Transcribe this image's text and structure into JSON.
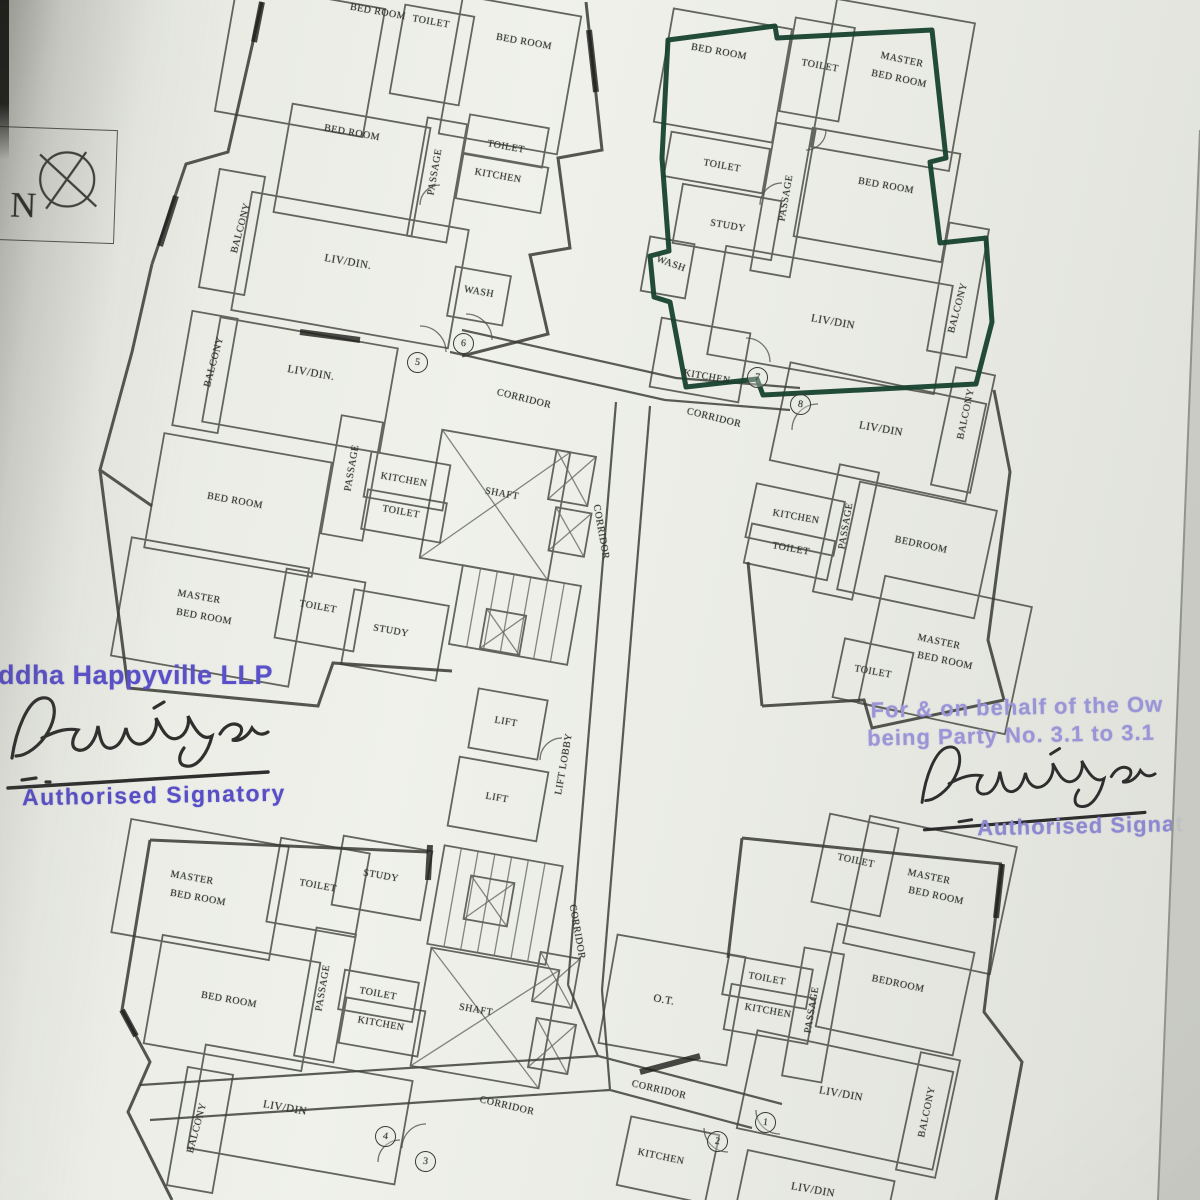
{
  "compass": {
    "label": "N"
  },
  "stamps": {
    "left": {
      "company": "ddha Happyville LLP",
      "signatory_title": "Authorised Signatory"
    },
    "right": {
      "line1": "For & on behalf of the Ow",
      "line2": "being Party No. 3.1 to 3.1",
      "signatory_title": "Authorised Signat"
    }
  },
  "colors": {
    "highlight_green": "#17412e",
    "stamp_purple": "#5a50c8",
    "stamp_lilac": "#9b95d8",
    "ink": "#1f1f1f",
    "wall": "#45473f",
    "paper": "#e8eae3"
  },
  "plan": {
    "labels": [
      {
        "t": "BED ROOM",
        "x": 378,
        "y": 12,
        "r": 10
      },
      {
        "t": "TOILET",
        "x": 431,
        "y": 22,
        "r": 10
      },
      {
        "t": "BED ROOM",
        "x": 524,
        "y": 42,
        "r": 10
      },
      {
        "t": "BED ROOM",
        "x": 352,
        "y": 133,
        "r": 10
      },
      {
        "t": "PASSAGE",
        "x": 435,
        "y": 172,
        "r": -80
      },
      {
        "t": "TOILET",
        "x": 506,
        "y": 147,
        "r": 10
      },
      {
        "t": "KITCHEN",
        "x": 498,
        "y": 176,
        "r": 10
      },
      {
        "t": "BALCONY",
        "x": 241,
        "y": 228,
        "r": -75
      },
      {
        "t": "LIV/DIN.",
        "x": 348,
        "y": 262,
        "r": 10,
        "s": 11
      },
      {
        "t": "WASH",
        "x": 479,
        "y": 292,
        "r": 10
      },
      {
        "t": "BALCONY",
        "x": 214,
        "y": 362,
        "r": -75
      },
      {
        "t": "LIV/DIN.",
        "x": 311,
        "y": 373,
        "r": 10,
        "s": 11
      },
      {
        "t": "CORRIDOR",
        "x": 524,
        "y": 399,
        "r": 14
      },
      {
        "t": "KITCHEN",
        "x": 404,
        "y": 480,
        "r": 10
      },
      {
        "t": "TOILET",
        "x": 401,
        "y": 512,
        "r": 10
      },
      {
        "t": "PASSAGE",
        "x": 352,
        "y": 468,
        "r": -80
      },
      {
        "t": "BED ROOM",
        "x": 235,
        "y": 501,
        "r": 10
      },
      {
        "t": "MASTER",
        "x": 199,
        "y": 597,
        "r": 10
      },
      {
        "t": "BED ROOM",
        "x": 204,
        "y": 617,
        "r": 10
      },
      {
        "t": "TOILET",
        "x": 318,
        "y": 607,
        "r": 10
      },
      {
        "t": "STUDY",
        "x": 391,
        "y": 631,
        "r": 10
      },
      {
        "t": "SHAFT",
        "x": 502,
        "y": 494,
        "r": 10
      },
      {
        "t": "CORRIDOR",
        "x": 601,
        "y": 532,
        "r": 80
      },
      {
        "t": "LIFT",
        "x": 506,
        "y": 722,
        "r": 10
      },
      {
        "t": "LIFT",
        "x": 497,
        "y": 798,
        "r": 10
      },
      {
        "t": "LIFT LOBBY",
        "x": 564,
        "y": 764,
        "r": -80
      },
      {
        "t": "CORRIDOR",
        "x": 577,
        "y": 932,
        "r": 80
      },
      {
        "t": "SHAFT",
        "x": 476,
        "y": 1010,
        "r": 10
      },
      {
        "t": "BED ROOM",
        "x": 719,
        "y": 52,
        "r": 10
      },
      {
        "t": "TOILET",
        "x": 820,
        "y": 66,
        "r": 10
      },
      {
        "t": "MASTER",
        "x": 902,
        "y": 60,
        "r": 12
      },
      {
        "t": "BED ROOM",
        "x": 899,
        "y": 79,
        "r": 12
      },
      {
        "t": "TOILET",
        "x": 722,
        "y": 166,
        "r": 10
      },
      {
        "t": "STUDY",
        "x": 728,
        "y": 226,
        "r": 10
      },
      {
        "t": "PASSAGE",
        "x": 786,
        "y": 198,
        "r": -80
      },
      {
        "t": "BED ROOM",
        "x": 886,
        "y": 186,
        "r": 10
      },
      {
        "t": "WASH",
        "x": 671,
        "y": 264,
        "r": 20
      },
      {
        "t": "KITCHEN",
        "x": 707,
        "y": 377,
        "r": 10
      },
      {
        "t": "LIV/DIN",
        "x": 833,
        "y": 322,
        "r": 10,
        "s": 11
      },
      {
        "t": "BALCONY",
        "x": 958,
        "y": 308,
        "r": -75
      },
      {
        "t": "CORRIDOR",
        "x": 714,
        "y": 418,
        "r": 14
      },
      {
        "t": "LIV/DIN",
        "x": 881,
        "y": 429,
        "r": 10,
        "s": 11
      },
      {
        "t": "BALCONY",
        "x": 966,
        "y": 414,
        "r": -78
      },
      {
        "t": "KITCHEN",
        "x": 796,
        "y": 517,
        "r": 10
      },
      {
        "t": "TOILET",
        "x": 791,
        "y": 549,
        "r": 10
      },
      {
        "t": "PASSAGE",
        "x": 846,
        "y": 526,
        "r": -80
      },
      {
        "t": "BEDROOM",
        "x": 921,
        "y": 545,
        "r": 12
      },
      {
        "t": "MASTER",
        "x": 939,
        "y": 642,
        "r": 12
      },
      {
        "t": "BED ROOM",
        "x": 945,
        "y": 661,
        "r": 12
      },
      {
        "t": "TOILET",
        "x": 873,
        "y": 672,
        "r": 10
      },
      {
        "t": "MASTER",
        "x": 192,
        "y": 878,
        "r": 10
      },
      {
        "t": "BED ROOM",
        "x": 198,
        "y": 898,
        "r": 10
      },
      {
        "t": "TOILET",
        "x": 318,
        "y": 886,
        "r": 10
      },
      {
        "t": "STUDY",
        "x": 381,
        "y": 876,
        "r": 10
      },
      {
        "t": "BED ROOM",
        "x": 229,
        "y": 1000,
        "r": 10
      },
      {
        "t": "PASSAGE",
        "x": 323,
        "y": 988,
        "r": -80
      },
      {
        "t": "TOILET",
        "x": 378,
        "y": 994,
        "r": 10
      },
      {
        "t": "KITCHEN",
        "x": 381,
        "y": 1024,
        "r": 10
      },
      {
        "t": "BALCONY",
        "x": 197,
        "y": 1128,
        "r": -75
      },
      {
        "t": "LIV/DIN",
        "x": 285,
        "y": 1108,
        "r": 10,
        "s": 11
      },
      {
        "t": "CORRIDOR",
        "x": 507,
        "y": 1106,
        "r": 13
      },
      {
        "t": "TOILET",
        "x": 856,
        "y": 861,
        "r": 12
      },
      {
        "t": "MASTER",
        "x": 929,
        "y": 877,
        "r": 12
      },
      {
        "t": "BED ROOM",
        "x": 936,
        "y": 896,
        "r": 12
      },
      {
        "t": "BEDROOM",
        "x": 898,
        "y": 984,
        "r": 12
      },
      {
        "t": "TOILET",
        "x": 767,
        "y": 979,
        "r": 10
      },
      {
        "t": "KITCHEN",
        "x": 768,
        "y": 1011,
        "r": 10
      },
      {
        "t": "PASSAGE",
        "x": 812,
        "y": 1010,
        "r": -80
      },
      {
        "t": "O.T.",
        "x": 664,
        "y": 1000,
        "r": 10,
        "s": 11
      },
      {
        "t": "CORRIDOR",
        "x": 659,
        "y": 1090,
        "r": 13
      },
      {
        "t": "KITCHEN",
        "x": 661,
        "y": 1157,
        "r": 12
      },
      {
        "t": "LIV/DIN",
        "x": 841,
        "y": 1094,
        "r": 10,
        "s": 11
      },
      {
        "t": "BALCONY",
        "x": 927,
        "y": 1112,
        "r": -78
      },
      {
        "t": "LIV/DIN",
        "x": 813,
        "y": 1190,
        "r": 10,
        "s": 11
      }
    ],
    "unit_circles": [
      {
        "n": "5",
        "x": 417,
        "y": 362
      },
      {
        "n": "6",
        "x": 463,
        "y": 343
      },
      {
        "n": "7",
        "x": 757,
        "y": 377
      },
      {
        "n": "8",
        "x": 800,
        "y": 404
      },
      {
        "n": "4",
        "x": 385,
        "y": 1136
      },
      {
        "n": "3",
        "x": 425,
        "y": 1161
      },
      {
        "n": "1",
        "x": 765,
        "y": 1122
      },
      {
        "n": "2",
        "x": 717,
        "y": 1141
      }
    ]
  }
}
